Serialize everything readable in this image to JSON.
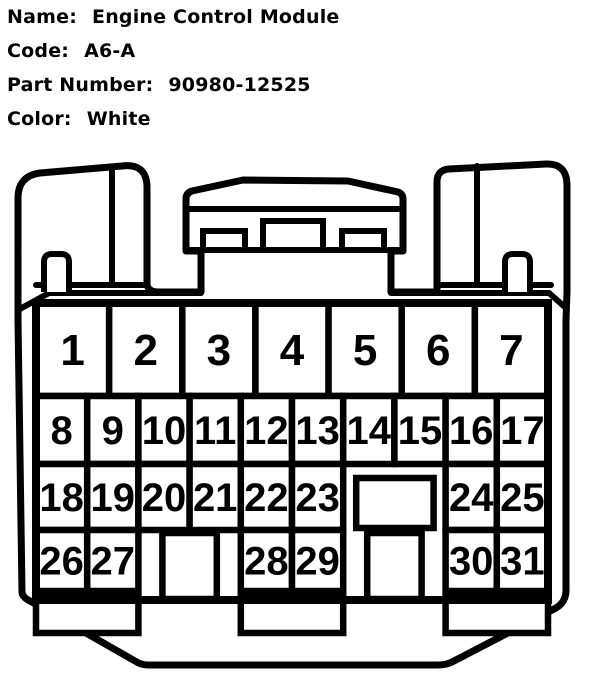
{
  "title": "Connector pinout diagram",
  "header": {
    "fields": [
      {
        "label": "Name:",
        "value": "Engine Control Module"
      },
      {
        "label": "Code:",
        "value": "A6-A"
      },
      {
        "label": "Part Number:",
        "value": "90980-12525"
      },
      {
        "label": "Color:",
        "value": "White"
      }
    ]
  },
  "connector": {
    "housing_color": "#ffffff",
    "line_color": "#000000",
    "pin_grid": {
      "row1_pins": [
        "1",
        "2",
        "3",
        "4",
        "5",
        "6",
        "7"
      ],
      "row2_pins": [
        "8",
        "9",
        "10",
        "11",
        "12",
        "13",
        "14",
        "15",
        "16",
        "17"
      ],
      "row3_cells": [
        {
          "pin": "18",
          "col": 0
        },
        {
          "pin": "19",
          "col": 1
        },
        {
          "pin": "20",
          "col": 2
        },
        {
          "pin": "21",
          "col": 3
        },
        {
          "pin": "22",
          "col": 4
        },
        {
          "pin": "23",
          "col": 5
        },
        {
          "pin": "24",
          "col": 8
        },
        {
          "pin": "25",
          "col": 9
        }
      ],
      "row4_cells": [
        {
          "pin": "26",
          "col": 0
        },
        {
          "pin": "27",
          "col": 1
        },
        {
          "pin": "28",
          "col": 4
        },
        {
          "pin": "29",
          "col": 5
        },
        {
          "pin": "30",
          "col": 8
        },
        {
          "pin": "31",
          "col": 9
        }
      ],
      "row3_blank_slot": {
        "cols": [
          6,
          8
        ]
      },
      "row4_key_slots": [
        {
          "cols": [
            2,
            4
          ]
        },
        {
          "cols": [
            6,
            8
          ]
        }
      ],
      "bottom_tabs": [
        {
          "cols": [
            0,
            2
          ]
        },
        {
          "cols": [
            4,
            6
          ]
        },
        {
          "cols": [
            8,
            10
          ]
        }
      ]
    }
  }
}
